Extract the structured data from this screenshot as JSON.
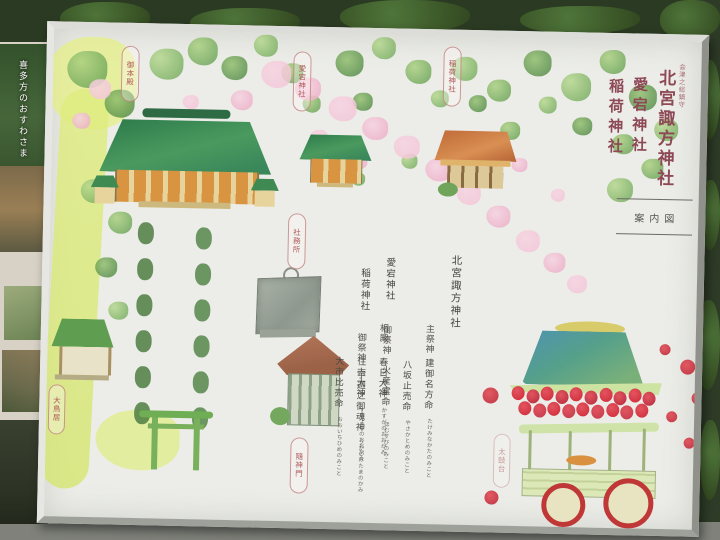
{
  "photo": {
    "left_poster": {
      "caption": "喜多方のおすわさま"
    }
  },
  "board": {
    "title": {
      "honorific": "会津之総鎮守",
      "lines": [
        "北宮諏方神社",
        "愛宕神社",
        "稲荷神社"
      ]
    },
    "map_box_label": "案内図",
    "legend": {
      "suwa": {
        "name": "北宮諏方神社",
        "sections": [
          {
            "heading": "主祭神",
            "deities": [
              {
                "name": "建御名方命",
                "furigana": "たけみなかたのみこと"
              },
              {
                "name": "八坂止売命",
                "furigana": "やさかとめのみこと"
              }
            ]
          },
          {
            "heading": "相殿",
            "deities": [
              {
                "name": "春日大神",
                "furigana": "かすがのおおかみ"
              },
              {
                "name": "住吉大神",
                "furigana": "すみよしのおおかみ"
              },
              {
                "name": "大市比売命",
                "furigana": "おおいちひめのみこと"
              }
            ]
          }
        ]
      },
      "atago": {
        "name": "愛宕神社",
        "heading": "御祭神",
        "deity": {
          "name": "火産霊命",
          "furigana": "ほむすびのみこと"
        }
      },
      "inari": {
        "name": "稲荷神社",
        "heading": "御祭神",
        "deity": {
          "name": "宇迦之御魂神",
          "furigana": "うかのみたまのかみ"
        }
      }
    },
    "map_labels": [
      "御本殿",
      "愛宕神社",
      "稲荷神社",
      "社務所",
      "大鳥居",
      "隨神門",
      "太鼓台"
    ],
    "colors": {
      "title_red": "#8d4a56",
      "roof_green": "#3a875a",
      "lantern_red": "#cf2936",
      "path_yellow": "#dfec7e",
      "blossom_pink": "#f3c3d6"
    }
  }
}
